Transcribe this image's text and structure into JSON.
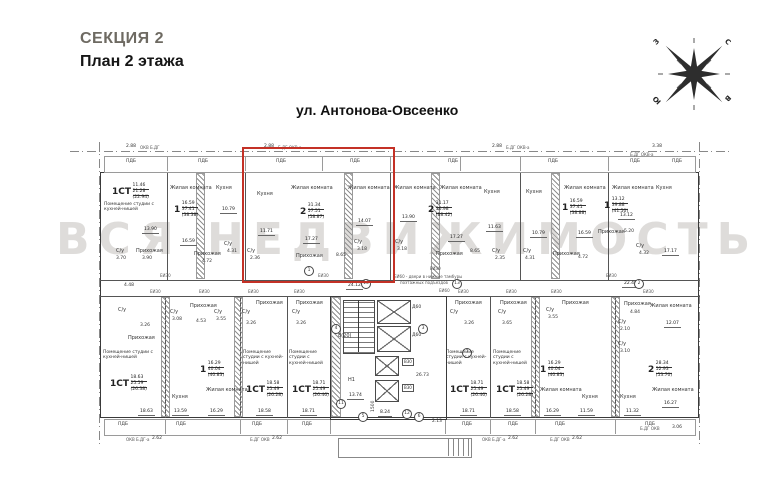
{
  "header": {
    "section": "СЕКЦИЯ 2",
    "floor": "План 2 этажа",
    "street": "ул. Антонова-Овсеенко"
  },
  "compass": {
    "n": "С",
    "w": "З",
    "s": "Ю",
    "e": "В"
  },
  "watermark": "ВСЯ НЕДВИЖИМОСТЬ",
  "labels": {
    "balcony": "ПДБ",
    "wc": "С/у",
    "hall": "Прихожая",
    "living": "Жилая комната",
    "kitchen": "Кухня",
    "studio": "Помещение студии с кухней-нишей",
    "door30": "ЕИ30",
    "door60": "ЕИ60",
    "lift": "Д60",
    "vent": "В30",
    "stair": "Н1",
    "flight": "8(20)"
  },
  "top_edge": {
    "d1": "2.88",
    "w1": "ОКВ Б.ДГ",
    "d2": "2.88",
    "w2": "Б.ДГ ОКВ-а",
    "d3": "2.88",
    "w3": "Б.ДГ ОКВ-а",
    "d4": "3.38",
    "w4": "Б.ДГ ОКВ-а"
  },
  "bottom_edge": {
    "w1": "ОКВ Б.ДГ-а",
    "d1": "2.62",
    "w2": "Б.ДГ ОКВ",
    "d2": "2.62",
    "w3": "ОКВ Б.ДГ-а",
    "d3": "2.62",
    "w4": "Б.ДГ ОКВ",
    "d4": "2.62",
    "w5": "Б.ДГ ОКВ",
    "d5": "3.06"
  },
  "corridor": {
    "d1": "4.48",
    "d2": "24.12",
    "d3": "22.46",
    "note1": "ЕИ60 - двери в нижние тамбуры",
    "note2": "поэтажных подъездов"
  },
  "core": {
    "d13": "13.74",
    "d26": "26.73",
    "d8": "8.24",
    "d15": "1500",
    "d2": "2.13"
  },
  "circles": {
    "c1": "1",
    "c2": "2",
    "c3": "3",
    "c4": "4",
    "c5": "5",
    "c6": "6",
    "c7": "7",
    "c10": "10",
    "c11": "11",
    "c12": "12",
    "c13": "13"
  },
  "apartments": {
    "a": {
      "type": "1СТ",
      "areas": [
        "11.46",
        "21.28",
        "(22.94)"
      ],
      "wc": "3.70",
      "hall": "3.90",
      "studio": "13.90",
      "corr": "4.48"
    },
    "b": {
      "type": "1",
      "areas": [
        "16.59",
        "37.41",
        "(38.38)"
      ],
      "living": "16.59",
      "kitchen": "10.79",
      "wc": "4.31",
      "hall": "4.72"
    },
    "c": {
      "type": "2",
      "areas": [
        "31.34",
        "57.51",
        "(58.87)"
      ],
      "kitchen": "11.71",
      "living1": "17.27",
      "living2": "14.07",
      "hall": "8.65",
      "wc1": "3.18",
      "wc2": "2.36"
    },
    "d": {
      "type": "2",
      "areas": [
        "31.17",
        "56.98",
        "(58.42)"
      ],
      "living1": "13.90",
      "living2": "17.27",
      "kitchen": "11.63",
      "hall": "8.65",
      "wc1": "3.18",
      "wc2": "2.35"
    },
    "e": {
      "type": "1",
      "areas": [
        "16.59",
        "37.41",
        "(38.88)"
      ],
      "kitchen": "10.79",
      "living": "16.59",
      "hall": "4.72",
      "wc": "4.31"
    },
    "f": {
      "type": "1",
      "areas": [
        "13.12",
        "39.88",
        "(41.50)"
      ],
      "living": "13.12",
      "hall": "5.20",
      "wc": "4.32",
      "dim": "17.17"
    },
    "g": {
      "type": "1СТ",
      "areas": [
        "18.63",
        "25.59",
        "(26.38)"
      ],
      "wc": "3.26",
      "dim": "18.63"
    },
    "h": {
      "type": "1",
      "areas": [
        "16.29",
        "40.04",
        "(40.83)"
      ],
      "wc1": "3.08",
      "hall": "4.53",
      "wc2": "3.55",
      "kitchen": "13.59",
      "living": "16.29"
    },
    "i": {
      "type": "1СТ",
      "areas": [
        "18.58",
        "25.49",
        "(26.28)"
      ],
      "wc": "3.26",
      "dim": "18.58"
    },
    "j": {
      "type": "1СТ",
      "areas": [
        "18.71",
        "25.49",
        "(26.46)"
      ],
      "wc": "3.26",
      "dim": "18.71"
    },
    "k": {
      "type": "1СТ",
      "areas": [
        "18.71",
        "25.49",
        "(26.46)"
      ],
      "wc": "3.26",
      "dim": "18.71"
    },
    "l": {
      "type": "1СТ",
      "areas": [
        "18.58",
        "25.49",
        "(26.28)"
      ],
      "wc": "3.65",
      "dim": "18.58"
    },
    "m": {
      "type": "1",
      "areas": [
        "16.29",
        "40.04",
        "(40.83)"
      ],
      "wc": "3.55",
      "living": "16.29",
      "kitchen": "11.59"
    },
    "n": {
      "type": "2",
      "areas": [
        "28.34",
        "52.93",
        "(53.70)"
      ],
      "hall": "4.84",
      "wc1": "2.10",
      "wc2": "3.10",
      "living1": "12.07",
      "kitchen": "11.32",
      "living2": "16.27",
      "dim": "22.46"
    }
  }
}
